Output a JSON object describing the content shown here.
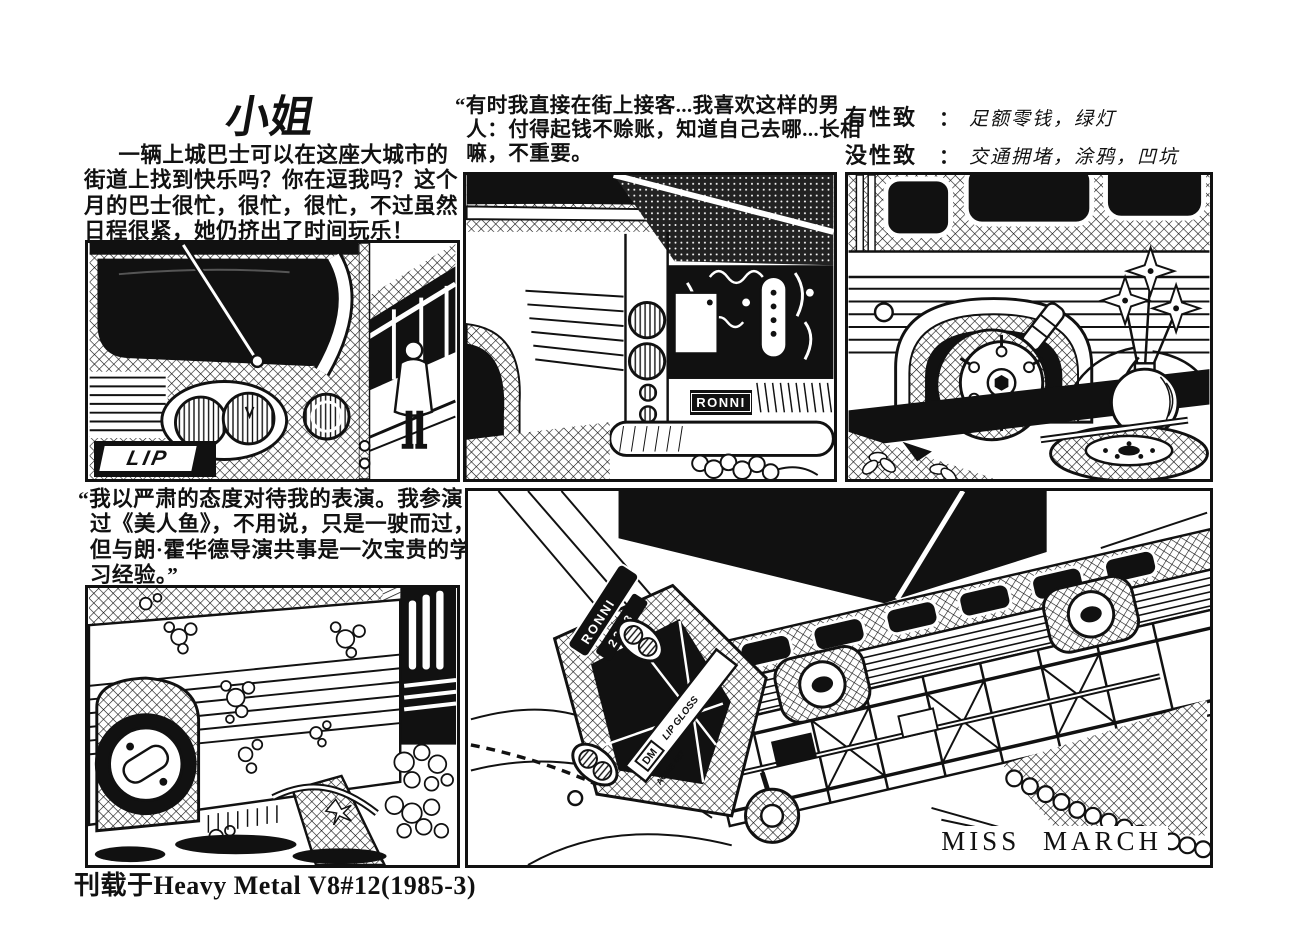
{
  "colors": {
    "ink": "#111111",
    "paper": "#ffffff"
  },
  "header": {
    "title": "小姐",
    "intro": "一辆上城巴士可以在这座大城市的街道上找到快乐吗？你在逗我吗？这个月的巴士很忙，很忙，很忙，不过虽然日程很紧，她仍挤出了时间玩乐！",
    "street_quote": "“有时我直接在街上接客...我喜欢这样的男人：付得起钱不赊账，知道自己去哪...长相嘛，不重要。",
    "turn_ons": {
      "label": "有性致",
      "colon": "：",
      "value": "足额零钱，绿灯"
    },
    "turn_offs": {
      "label": "没性致",
      "colon": "：",
      "value": "交通拥堵，涂鸦，凹坑"
    }
  },
  "quotes": {
    "acting": "“我以严肃的态度对待我的表演。我参演过《美人鱼》，不用说，只是一驶而过，但与朗·霍华德导演共事是一次宝贵的学习经验。”"
  },
  "bus_labels": {
    "front_plate": "LIP",
    "rear_plate": "RONNI",
    "route_name": "RONNI",
    "route_number": "2223",
    "decal_dm": "DM",
    "decal_lip_gloss": "LIP GLOSS",
    "decal_acme": "ACME 487"
  },
  "centerfold": {
    "caption": "MISS MARCH"
  },
  "footer": {
    "source": "刊载于Heavy Metal V8#12(1985-3)"
  }
}
